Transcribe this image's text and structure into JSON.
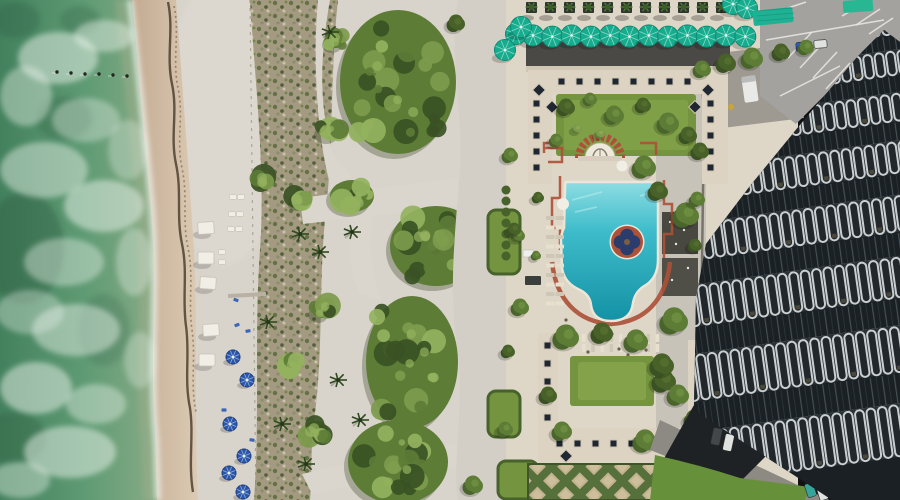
{
  "scene": {
    "title": "aerial-beachfront-resort-photo",
    "palette": {
      "ocean_deep": "#3f7a58",
      "ocean_mid": "#5f9b74",
      "ocean_shallow": "#93b18d",
      "ocean_dark_patch": "#2f5c42",
      "foam": "#edf4ee",
      "wet_sand": "#cdb69e",
      "wet_sand_light": "#dbc9b2",
      "sand": "#d8d3cb",
      "beach_bright": "#e0dcd4",
      "seaweed": "#4e4130",
      "scrub_base": "#a39a81",
      "scrub_green": "#5c6e3c",
      "scrub_dark": "#475733",
      "veg_dark": "#3a5124",
      "veg_mid": "#5d7c36",
      "veg_light": "#7d9b4c",
      "veg_highlight": "#94b25e",
      "path": "#dbd6cd",
      "walkway": "#d3cfc7",
      "deck": "#ded6c6",
      "roof_dark": "#4b4946",
      "roof_tan": "#dcd3c2",
      "skylight": "#1f2733",
      "lawn": "#75943f",
      "lawn_light": "#8cab52",
      "hedge": "#48622c",
      "terracotta": "#ad5138",
      "coping": "#ece6d8",
      "pool_light": "#8edde2",
      "pool_mid": "#36b7c8",
      "pool_deep": "#1391a5",
      "medallion_navy": "#2b3d6d",
      "medallion_center": "#7c5e42",
      "umbrella_teal": "#16ac8e",
      "umbrella_teal_dark": "#0b8a72",
      "awning_teal": "#1fb193",
      "umbrella_blue": "#2a57ab",
      "umbrella_blue_dark": "#1c3e7e",
      "cabana": "#f1eee6",
      "lounger": "#e7e0cf",
      "parking": "#a4a29e",
      "parking_line": "#eceae6",
      "service": "#9e9a92",
      "glass": "#1a2024",
      "fin_face": "#c9ced0",
      "fin_gap": "#21272b",
      "band_top": "#e8ebea",
      "shadow": "#1f2224",
      "drive": "#8d8a84",
      "lawn_bright": "#67903b",
      "truck": "#e9eae8",
      "car_blue": "#2e5cb4",
      "car_white": "#e0e2e0",
      "car_dark": "#43474a",
      "car_teal": "#37a49b",
      "car_red": "#ad3a2c",
      "car_green": "#27b893"
    },
    "ocean": {
      "pilings": [
        [
          57,
          72
        ],
        [
          71,
          73
        ],
        [
          85,
          74
        ],
        [
          99,
          74
        ],
        [
          113,
          75
        ],
        [
          127,
          76
        ]
      ]
    },
    "beach": {
      "white_cabanas": [
        [
          206,
          228
        ],
        [
          206,
          258
        ],
        [
          208,
          283
        ],
        [
          211,
          330
        ],
        [
          207,
          360
        ]
      ],
      "white_loungers": [
        [
          233,
          197
        ],
        [
          241,
          197
        ],
        [
          232,
          214
        ],
        [
          240,
          214
        ],
        [
          231,
          229
        ],
        [
          239,
          229
        ],
        [
          222,
          252
        ],
        [
          222,
          262
        ]
      ],
      "blue_umbrellas": [
        [
          233,
          357
        ],
        [
          247,
          380
        ],
        [
          230,
          424
        ],
        [
          244,
          456
        ],
        [
          229,
          473
        ],
        [
          243,
          492
        ]
      ],
      "blue_chairs": [
        [
          237,
          325
        ],
        [
          248,
          331
        ],
        [
          224,
          410
        ],
        [
          252,
          440
        ],
        [
          236,
          300
        ]
      ],
      "boardwalk": {
        "x1": 228,
        "y1": 296,
        "x2": 266,
        "y2": 294
      }
    },
    "vegetation": {
      "clusters": [
        [
          398,
          82,
          58,
          72,
          3
        ],
        [
          352,
          196,
          22,
          16,
          5
        ],
        [
          436,
          246,
          46,
          40,
          7
        ],
        [
          412,
          362,
          46,
          66,
          9
        ],
        [
          398,
          462,
          50,
          42,
          11
        ],
        [
          497,
          62,
          28,
          60,
          13
        ],
        [
          521,
          18,
          16,
          12,
          15
        ],
        [
          336,
          40,
          10,
          8,
          17
        ],
        [
          330,
          130,
          12,
          9,
          19
        ],
        [
          322,
          310,
          10,
          8,
          21
        ],
        [
          316,
          430,
          12,
          9,
          23
        ],
        [
          300,
          200,
          8,
          6,
          25
        ],
        [
          262,
          180,
          7,
          5,
          27
        ],
        [
          292,
          365,
          8,
          6,
          29
        ]
      ],
      "palms": [
        [
          300,
          234
        ],
        [
          320,
          252
        ],
        [
          282,
          424
        ],
        [
          306,
          464
        ],
        [
          268,
          322
        ],
        [
          488,
          458
        ],
        [
          352,
          232
        ],
        [
          338,
          380
        ],
        [
          360,
          420
        ],
        [
          330,
          32
        ]
      ]
    },
    "resort": {
      "planter_row": {
        "y": 2,
        "start_x": 526,
        "spacing": 19,
        "count": 11,
        "size": 11
      },
      "umbrella_row": {
        "count": 12,
        "start_x": 533,
        "spacing": 19.3,
        "y": 36,
        "r": 10.5,
        "extras": [
          [
            516,
            34
          ],
          [
            505,
            50
          ],
          [
            521,
            27
          ],
          [
            733,
            4
          ],
          [
            747,
            8
          ]
        ]
      },
      "awning": {
        "x": 753,
        "y": 9,
        "w": 40,
        "h": 15,
        "rot": -6
      },
      "skylights": {
        "size": 7,
        "upper_row": {
          "y": 78,
          "xs": [
            558,
            576,
            594,
            612,
            630,
            648,
            666,
            684
          ]
        },
        "left_col": {
          "x": 533,
          "ys": [
            100,
            116,
            132,
            148,
            164
          ]
        },
        "right_col": {
          "x": 707,
          "ys": [
            100,
            116,
            132,
            148,
            164
          ]
        },
        "lower_row": {
          "y": 440,
          "xs": [
            556,
            574,
            592,
            610,
            628,
            646,
            664,
            682
          ]
        },
        "lower_left_col": {
          "x": 544,
          "ys": [
            342,
            360,
            378,
            396,
            414
          ]
        },
        "diamonds": [
          [
            539,
            90
          ],
          [
            552,
            107
          ],
          [
            708,
            90
          ],
          [
            695,
            107
          ],
          [
            566,
            456
          ],
          [
            678,
            455
          ]
        ]
      },
      "pool_loungers": {
        "west": {
          "xs": [
            546,
            555.5
          ],
          "y0": 216,
          "step": 9.5,
          "n": 10,
          "w": 8.5,
          "h": 4
        },
        "south": {
          "ys": [
            334,
            344
          ],
          "x0": 582,
          "step": 9.2,
          "n": 9,
          "w": 3.6,
          "h": 8
        }
      },
      "people_dots": [
        [
          598,
          341
        ],
        [
          619,
          349
        ],
        [
          634,
          338
        ],
        [
          588,
          352
        ],
        [
          612,
          334
        ],
        [
          566,
          320
        ],
        [
          646,
          350
        ],
        [
          628,
          355
        ],
        [
          575,
          340
        ]
      ],
      "hedge_row": {
        "x": 506,
        "y0": 190,
        "step": 11,
        "n": 7,
        "r": 4.5
      },
      "lawn_patches": [
        {
          "x": 488,
          "y": 210,
          "w": 32,
          "h": 64
        },
        {
          "x": 488,
          "y": 391,
          "w": 32,
          "h": 46
        },
        {
          "x": 498,
          "y": 461,
          "w": 40,
          "h": 38
        }
      ],
      "trees": [
        [
          566,
          108,
          9,
          0
        ],
        [
          590,
          100,
          7,
          1
        ],
        [
          614,
          116,
          10,
          1
        ],
        [
          643,
          106,
          8,
          0
        ],
        [
          668,
          124,
          11,
          1
        ],
        [
          688,
          136,
          9,
          0
        ],
        [
          577,
          129,
          5,
          2
        ],
        [
          600,
          134,
          5,
          2
        ],
        [
          644,
          168,
          12,
          1
        ],
        [
          658,
          192,
          10,
          0
        ],
        [
          556,
          141,
          7,
          1
        ],
        [
          686,
          216,
          13,
          1
        ],
        [
          674,
          322,
          14,
          1
        ],
        [
          664,
          382,
          12,
          0
        ],
        [
          697,
          200,
          8,
          1
        ],
        [
          700,
          152,
          9,
          0
        ],
        [
          695,
          246,
          7,
          0
        ],
        [
          538,
          198,
          6,
          0
        ],
        [
          536,
          256,
          5,
          1
        ],
        [
          518,
          236,
          7,
          1
        ],
        [
          566,
          338,
          13,
          1
        ],
        [
          602,
          334,
          11,
          0
        ],
        [
          636,
          342,
          12,
          1
        ],
        [
          662,
          366,
          12,
          0
        ],
        [
          678,
          396,
          11,
          1
        ],
        [
          548,
          396,
          9,
          0
        ],
        [
          562,
          432,
          10,
          1
        ],
        [
          645,
          442,
          12,
          1
        ],
        [
          688,
          468,
          10,
          0
        ],
        [
          694,
          420,
          10,
          0
        ],
        [
          756,
          478,
          9,
          1
        ],
        [
          702,
          70,
          9,
          1
        ],
        [
          726,
          64,
          10,
          0
        ],
        [
          752,
          59,
          11,
          1
        ],
        [
          781,
          53,
          9,
          0
        ],
        [
          806,
          48,
          8,
          1
        ],
        [
          510,
          156,
          8,
          1
        ],
        [
          514,
          230,
          7,
          0
        ],
        [
          520,
          308,
          9,
          1
        ],
        [
          508,
          352,
          7,
          0
        ],
        [
          505,
          430,
          8,
          1
        ],
        [
          473,
          486,
          10,
          1
        ],
        [
          456,
          24,
          9,
          0
        ]
      ]
    },
    "parking": {
      "lines": [
        [
          766,
          40,
          884,
          20
        ],
        [
          788,
          58,
          812,
          32
        ],
        [
          800,
          68,
          824,
          42
        ],
        [
          813,
          78,
          837,
          52
        ],
        [
          826,
          89,
          850,
          63
        ],
        [
          842,
          16,
          866,
          2
        ],
        [
          856,
          25,
          880,
          9
        ],
        [
          869,
          34,
          893,
          18
        ],
        [
          780,
          96,
          840,
          66
        ],
        [
          782,
          10,
          806,
          2
        ]
      ],
      "cars": [
        {
          "x": 796,
          "y": 42,
          "w": 16,
          "h": 9,
          "r": -4,
          "c": "car_blue"
        },
        {
          "x": 814,
          "y": 40,
          "w": 13,
          "h": 8,
          "r": -4,
          "c": "car_white"
        },
        {
          "x": 848,
          "y": 3,
          "w": 15,
          "h": 8,
          "r": -6,
          "c": "car_dark"
        }
      ]
    },
    "south_cars": [
      {
        "x": 806,
        "y": 483,
        "w": 9,
        "h": 14,
        "r": -18,
        "c": "car_teal"
      },
      {
        "x": 818,
        "y": 486,
        "w": 9,
        "h": 14,
        "r": -18,
        "c": "car_white"
      },
      {
        "x": 831,
        "y": 490,
        "w": 8,
        "h": 12,
        "r": -18,
        "c": "car_red"
      },
      {
        "x": 712,
        "y": 428,
        "w": 9,
        "h": 17,
        "r": 12,
        "c": "car_dark"
      },
      {
        "x": 724,
        "y": 434,
        "w": 9,
        "h": 17,
        "r": 12,
        "c": "car_white"
      }
    ],
    "tower": {
      "angle": -8,
      "cx": 806,
      "cy": 256,
      "x": 590,
      "width": 480,
      "y0": -18,
      "glass0": 11,
      "balc0": 20,
      "growth": 1.13,
      "bands": 9,
      "fin_step": 11.5
    }
  }
}
